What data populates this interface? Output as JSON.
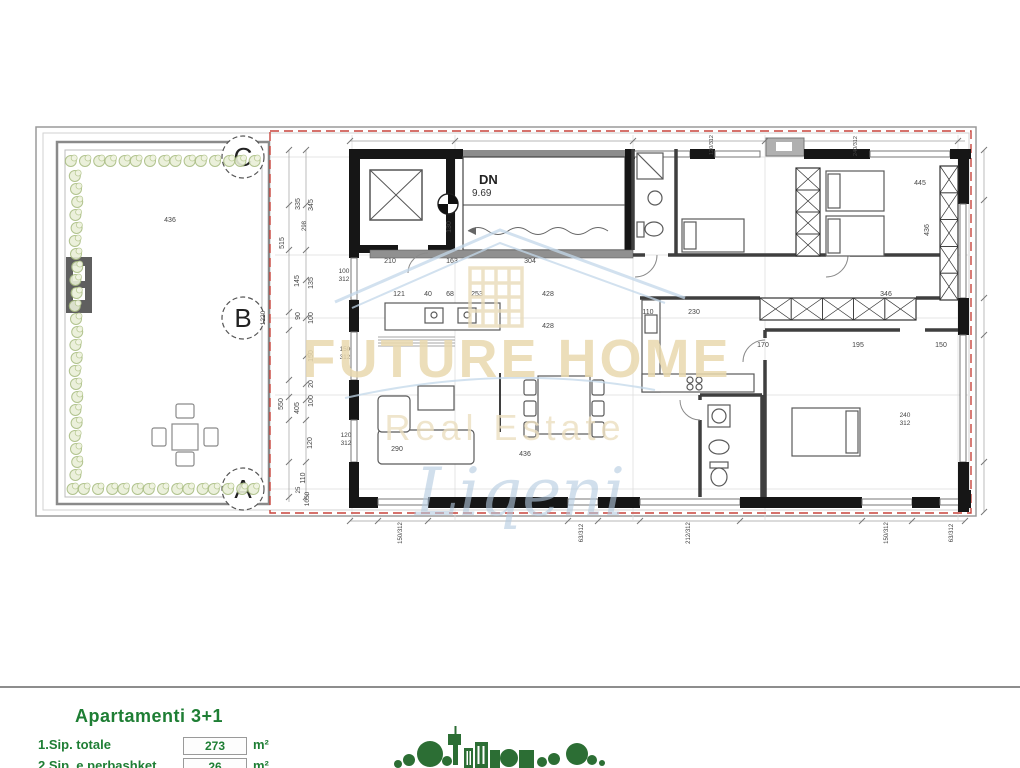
{
  "drawing": {
    "grid_markers": [
      "C",
      "B",
      "A"
    ],
    "stairs_label": "DN",
    "stairs_level": "9.69",
    "boundary_color": "#c8443c",
    "labels": [
      {
        "t": "210",
        "x": 390,
        "y": 263
      },
      {
        "t": "163",
        "x": 452,
        "y": 263
      },
      {
        "t": "304",
        "x": 530,
        "y": 263
      },
      {
        "t": "121",
        "x": 399,
        "y": 296
      },
      {
        "t": "40",
        "x": 428,
        "y": 296
      },
      {
        "t": "68",
        "x": 450,
        "y": 296
      },
      {
        "t": "253",
        "x": 477,
        "y": 296
      },
      {
        "t": "428",
        "x": 548,
        "y": 296
      },
      {
        "t": "428",
        "x": 548,
        "y": 328
      },
      {
        "t": "110",
        "x": 648,
        "y": 314
      },
      {
        "t": "230",
        "x": 694,
        "y": 314
      },
      {
        "t": "170",
        "x": 763,
        "y": 347
      },
      {
        "t": "195",
        "x": 858,
        "y": 347
      },
      {
        "t": "150",
        "x": 941,
        "y": 347
      },
      {
        "t": "346",
        "x": 886,
        "y": 296
      },
      {
        "t": "445",
        "x": 920,
        "y": 185
      },
      {
        "t": "436",
        "x": 170,
        "y": 222
      },
      {
        "t": "436",
        "x": 525,
        "y": 456
      },
      {
        "t": "290",
        "x": 397,
        "y": 451
      },
      {
        "t": "100",
        "x": 344,
        "y": 273,
        "s": 6.5
      },
      {
        "t": "312",
        "x": 344,
        "y": 281,
        "s": 6.5
      },
      {
        "t": "150",
        "x": 345,
        "y": 351,
        "s": 6.5
      },
      {
        "t": "312",
        "x": 345,
        "y": 359,
        "s": 6.5
      },
      {
        "t": "120",
        "x": 346,
        "y": 437,
        "s": 6.5
      },
      {
        "t": "312",
        "x": 346,
        "y": 445,
        "s": 6.5
      },
      {
        "t": "240",
        "x": 905,
        "y": 417,
        "s": 6.5
      },
      {
        "t": "312",
        "x": 905,
        "y": 425,
        "s": 6.5
      },
      {
        "t": "335",
        "x": 300,
        "y": 204,
        "r": -90
      },
      {
        "t": "345",
        "x": 313,
        "y": 205,
        "r": -90
      },
      {
        "t": "298",
        "x": 306,
        "y": 226,
        "r": -90,
        "s": 6
      },
      {
        "t": "515",
        "x": 284,
        "y": 243,
        "r": -90
      },
      {
        "t": "145",
        "x": 299,
        "y": 281,
        "r": -90
      },
      {
        "t": "135",
        "x": 313,
        "y": 283,
        "r": -90
      },
      {
        "t": "90",
        "x": 300,
        "y": 316,
        "r": -90
      },
      {
        "t": "100",
        "x": 313,
        "y": 318,
        "r": -90
      },
      {
        "t": "150",
        "x": 313,
        "y": 356,
        "r": -90
      },
      {
        "t": "20",
        "x": 313,
        "y": 384,
        "r": -90
      },
      {
        "t": "100",
        "x": 313,
        "y": 401,
        "r": -90
      },
      {
        "t": "550",
        "x": 283,
        "y": 404,
        "r": -90
      },
      {
        "t": "405",
        "x": 299,
        "y": 408,
        "r": -90
      },
      {
        "t": "120",
        "x": 312,
        "y": 443,
        "r": -90
      },
      {
        "t": "110",
        "x": 305,
        "y": 478,
        "r": -90
      },
      {
        "t": "25",
        "x": 300,
        "y": 490,
        "r": -90,
        "s": 6
      },
      {
        "t": "1050",
        "x": 309,
        "y": 499,
        "r": -90,
        "s": 6.5
      },
      {
        "t": "1220",
        "x": 265,
        "y": 318,
        "r": -90,
        "s": 6.5
      },
      {
        "t": "130",
        "x": 451,
        "y": 227,
        "r": -90
      },
      {
        "t": "436",
        "x": 929,
        "y": 230,
        "r": -90
      },
      {
        "t": "120/312",
        "x": 713,
        "y": 145,
        "r": -90,
        "s": 5.5
      },
      {
        "t": "240/312",
        "x": 857,
        "y": 146,
        "r": -90,
        "s": 5.5
      },
      {
        "t": "150/312",
        "x": 402,
        "y": 533,
        "r": -90,
        "s": 6
      },
      {
        "t": "63/312",
        "x": 583,
        "y": 533,
        "r": -90,
        "s": 6
      },
      {
        "t": "212/312",
        "x": 690,
        "y": 533,
        "r": -90,
        "s": 6
      },
      {
        "t": "150/312",
        "x": 888,
        "y": 533,
        "r": -90,
        "s": 6
      },
      {
        "t": "63/312",
        "x": 953,
        "y": 533,
        "r": -90,
        "s": 6
      }
    ]
  },
  "watermark": {
    "brand": "FUTURE HOME",
    "tagline": "Real Estate",
    "script": "Liqeni",
    "brand_color": "#e9d9ae",
    "house_color": "#c3d8ea",
    "script_color": "#b4cbe0"
  },
  "title_block": {
    "title": "Apartamenti 3+1",
    "accent": "#1e7e34",
    "rows": [
      {
        "label": "1.Sip. totale",
        "value": "273",
        "unit": "m²"
      },
      {
        "label": "2.Sip. e perbashket",
        "value": "26",
        "unit": "m²"
      }
    ]
  }
}
